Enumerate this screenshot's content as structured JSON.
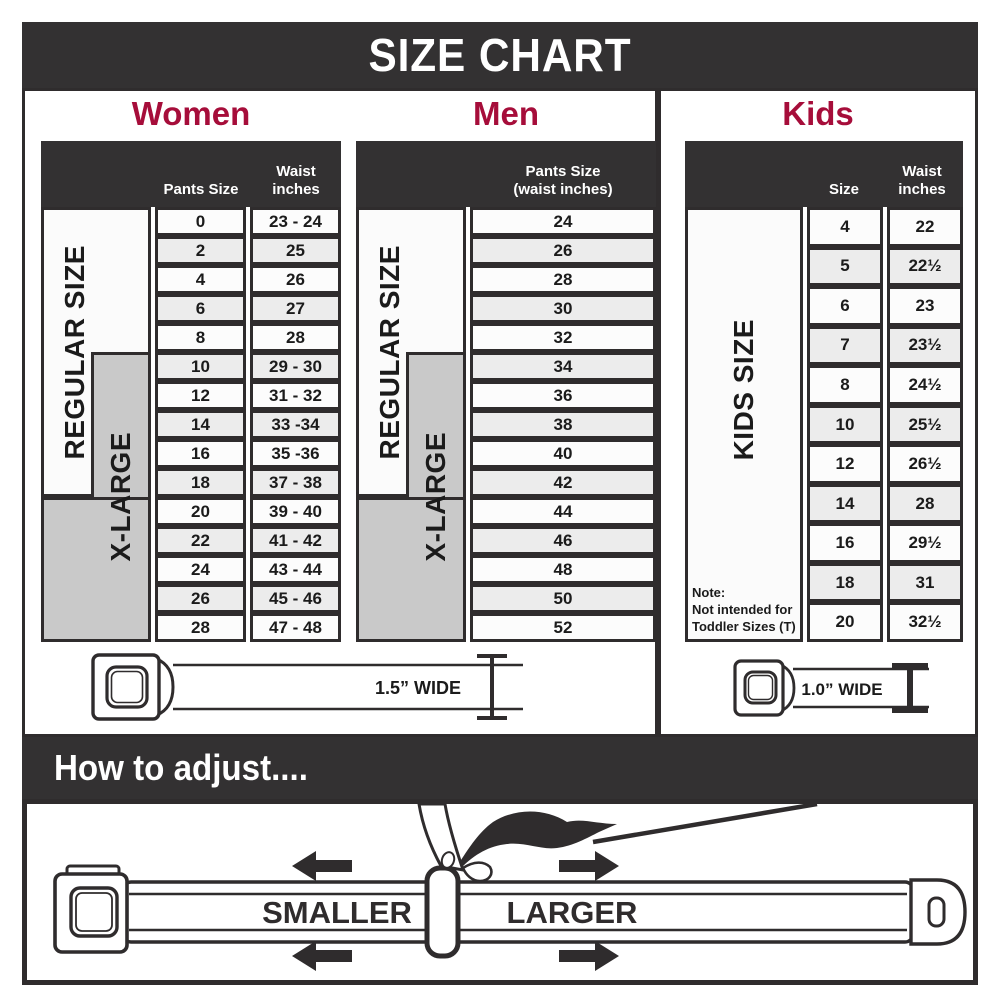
{
  "title": "SIZE CHART",
  "colors": {
    "accent_red": "#A60D3A",
    "bar_dark": "#333132",
    "band_gray": "#C9C9C9",
    "row_alt": "#ECECEC",
    "border_dark": "#2F2C2D"
  },
  "women": {
    "heading": "Women",
    "regular_label": "REGULAR SIZE",
    "xlarge_label": "X-LARGE",
    "columns": {
      "pants": "Pants Size",
      "waist": "Waist\ninches"
    },
    "rows": [
      {
        "size": "0",
        "waist": "23 - 24"
      },
      {
        "size": "2",
        "waist": "25"
      },
      {
        "size": "4",
        "waist": "26"
      },
      {
        "size": "6",
        "waist": "27"
      },
      {
        "size": "8",
        "waist": "28"
      },
      {
        "size": "10",
        "waist": "29 - 30"
      },
      {
        "size": "12",
        "waist": "31 - 32"
      },
      {
        "size": "14",
        "waist": "33 -34"
      },
      {
        "size": "16",
        "waist": "35 -36"
      },
      {
        "size": "18",
        "waist": "37 - 38"
      },
      {
        "size": "20",
        "waist": "39 - 40"
      },
      {
        "size": "22",
        "waist": "41 - 42"
      },
      {
        "size": "24",
        "waist": "43 - 44"
      },
      {
        "size": "26",
        "waist": "45 - 46"
      },
      {
        "size": "28",
        "waist": "47 - 48"
      }
    ]
  },
  "men": {
    "heading": "Men",
    "regular_label": "REGULAR SIZE",
    "xlarge_label": "X-LARGE",
    "columns": {
      "pants": "Pants Size\n(waist inches)"
    },
    "rows": [
      "24",
      "26",
      "28",
      "30",
      "32",
      "34",
      "36",
      "38",
      "40",
      "42",
      "44",
      "46",
      "48",
      "50",
      "52"
    ]
  },
  "kids": {
    "heading": "Kids",
    "side_label": "KIDS SIZE",
    "columns": {
      "size": "Size",
      "waist": "Waist\ninches"
    },
    "rows": [
      {
        "size": "4",
        "waist": "22"
      },
      {
        "size": "5",
        "waist": "22½"
      },
      {
        "size": "6",
        "waist": "23"
      },
      {
        "size": "7",
        "waist": "23½"
      },
      {
        "size": "8",
        "waist": "24½"
      },
      {
        "size": "10",
        "waist": "25½"
      },
      {
        "size": "12",
        "waist": "26½"
      },
      {
        "size": "14",
        "waist": "28"
      },
      {
        "size": "16",
        "waist": "29½"
      },
      {
        "size": "18",
        "waist": "31"
      },
      {
        "size": "20",
        "waist": "32½"
      }
    ],
    "note": "Note:\nNot intended for\nToddler Sizes (T)"
  },
  "belts": {
    "adult_width_label": "1.5” WIDE",
    "kids_width_label": "1.0” WIDE"
  },
  "adjust": {
    "heading": "How to adjust....",
    "smaller_label": "SMALLER",
    "larger_label": "LARGER"
  }
}
